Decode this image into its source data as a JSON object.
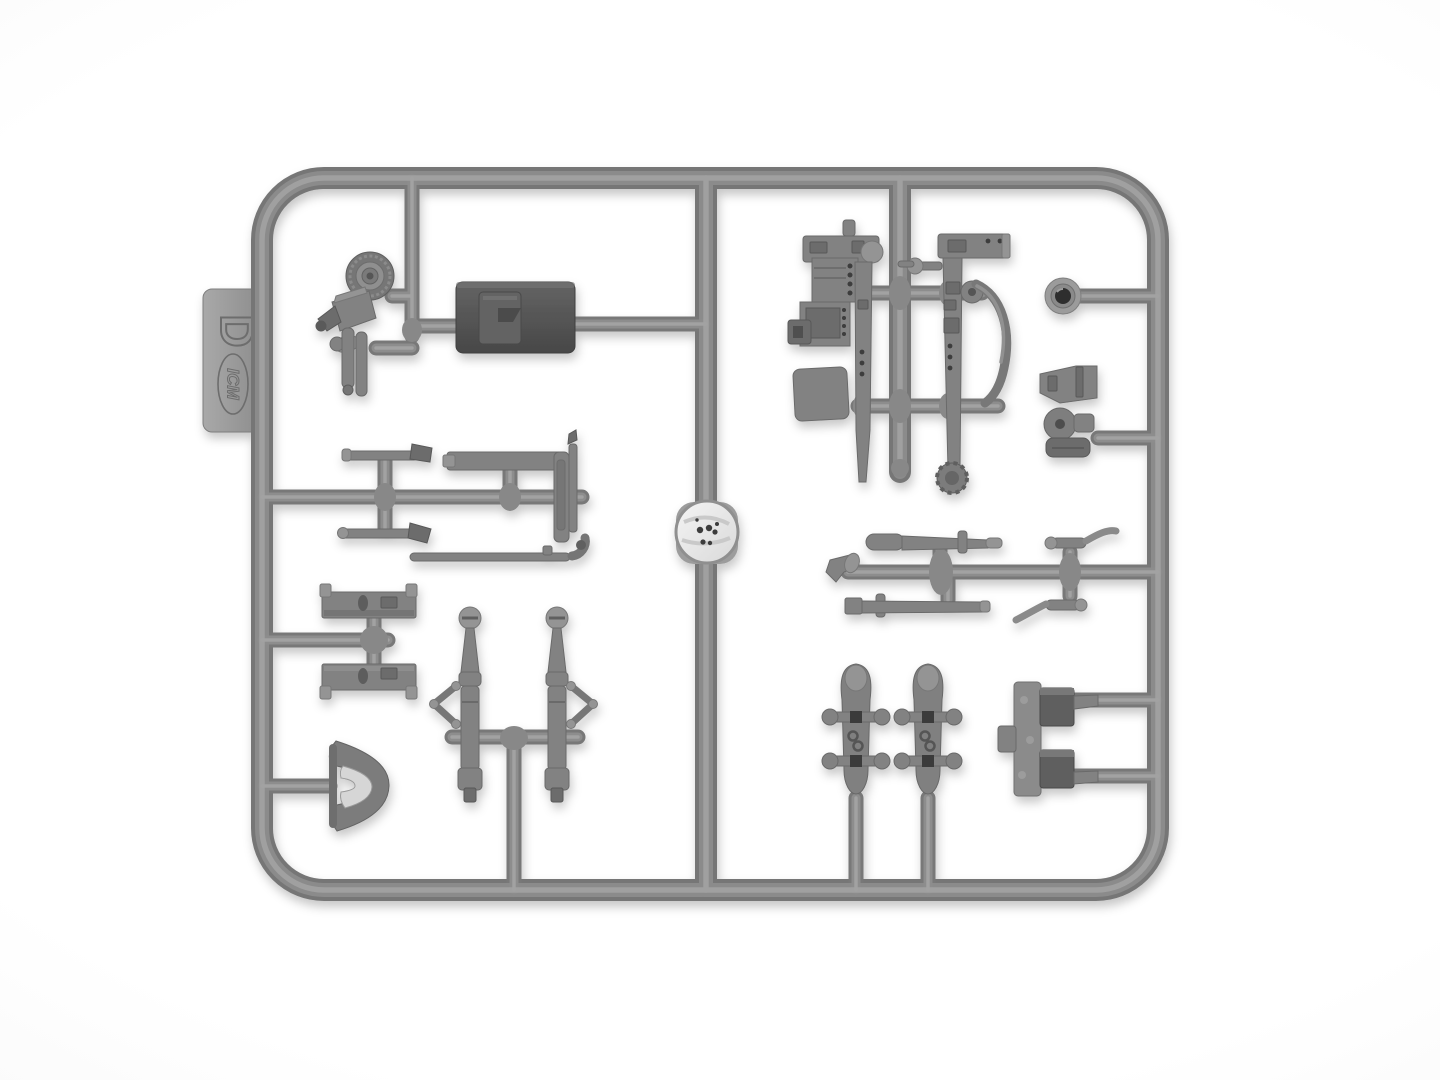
{
  "photo": {
    "subject": "Injection-molded plastic model kit sprue (parts runner) photographed flat on a white background",
    "sprue": {
      "label": "D",
      "brand": "ICM",
      "plastic_color": "#8d8d8d",
      "dark_plastic_color": "#555555",
      "background_color": "#fbfbfb"
    },
    "parts": [
      {
        "id": "road-wheel",
        "desc": "small spoked wheel with treaded tire, top left"
      },
      {
        "id": "searchlight-pump",
        "desc": "angled housing with nozzle and twin cylinders below the wheel"
      },
      {
        "id": "stowage-box",
        "desc": "dark rectangular box / seat with recessed panel"
      },
      {
        "id": "tool-rod-upper",
        "desc": "short tool rod above left-middle runner"
      },
      {
        "id": "tool-rod-lower",
        "desc": "short tool rod below left-middle runner"
      },
      {
        "id": "l-bracket",
        "desc": "L-shaped bracket on left-middle runner"
      },
      {
        "id": "linkage-rod",
        "desc": "long thin rod with elbow joint"
      },
      {
        "id": "footboard-upper",
        "desc": "channel-section footboard bar with end tabs"
      },
      {
        "id": "footboard-lower",
        "desc": "mirrored channel-section footboard bar"
      },
      {
        "id": "crescent-fender",
        "desc": "half-moon fender/visor, lower left"
      },
      {
        "id": "recoil-cylinder-left",
        "desc": "vertical tapered cylinder with diamond linkage arm"
      },
      {
        "id": "recoil-cylinder-right",
        "desc": "mirrored vertical tapered cylinder with diamond linkage arm"
      },
      {
        "id": "steering-wheel-disc",
        "desc": "bright circular disc with dark specks molded on the center runner"
      },
      {
        "id": "mg-mount-left",
        "desc": "long machine-gun/mount column with ammunition boxes"
      },
      {
        "id": "mg-mount-right",
        "desc": "long column with curved cocking lever and roller foot"
      },
      {
        "id": "lens-light",
        "desc": "small round lamp with dark lens, upper right"
      },
      {
        "id": "gun-cradle",
        "desc": "bracket with round hub and curved foot, right side"
      },
      {
        "id": "barrel-upper",
        "desc": "tapered gun barrel above middle-right runner"
      },
      {
        "id": "barrel-lower",
        "desc": "tapered gun barrel with square cap below middle-right runner"
      },
      {
        "id": "muzzle-hook",
        "desc": "small forked tip at left end of middle-right runner"
      },
      {
        "id": "crank-upper",
        "desc": "small crank handle, upper"
      },
      {
        "id": "crank-lower",
        "desc": "small crank handle, lower"
      },
      {
        "id": "bogie-left",
        "desc": "elongated bogie with four stub wheels and dark hubs"
      },
      {
        "id": "bogie-right",
        "desc": "identical elongated bogie with four stub wheels"
      },
      {
        "id": "u-bracket",
        "desc": "U-shaped mount with two dark block arms, bottom right"
      }
    ]
  }
}
